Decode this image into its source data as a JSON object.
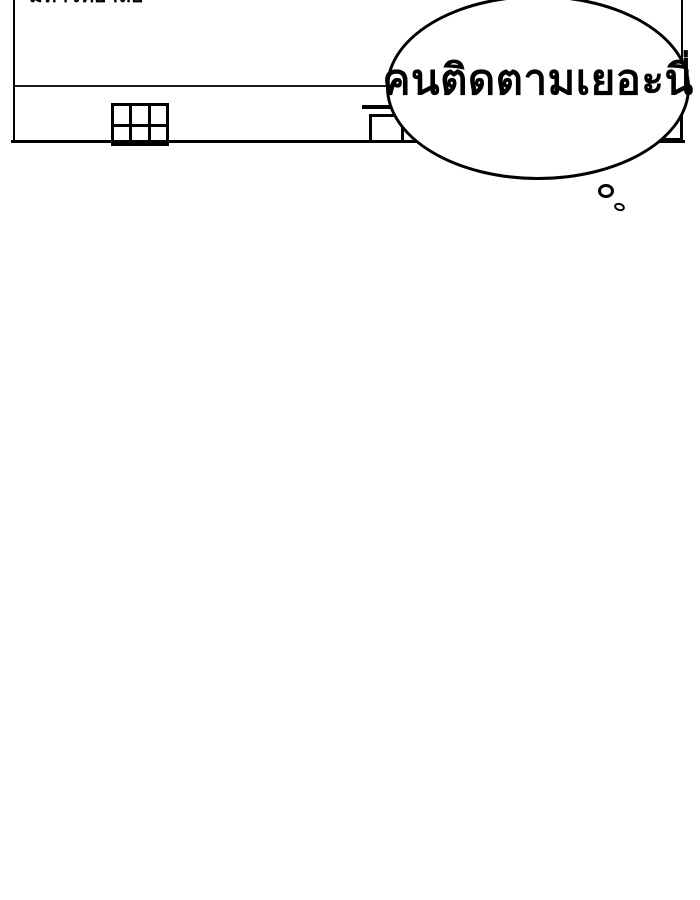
{
  "page": {
    "kind": "webtoon-comic-panel",
    "background_color": "#ffffff",
    "ink_color": "#000000"
  },
  "panel": {
    "caption_top_clipped": "มหาวิทยาลัย",
    "building": {
      "description": "building facade with roofline, gridded window, door with awning, right-edge window"
    }
  },
  "thought_bubble": {
    "text": "คนติดตามเยอะนี่",
    "fill": "#ffffff",
    "stroke": "#000000",
    "trail_bubble_count": 2
  }
}
